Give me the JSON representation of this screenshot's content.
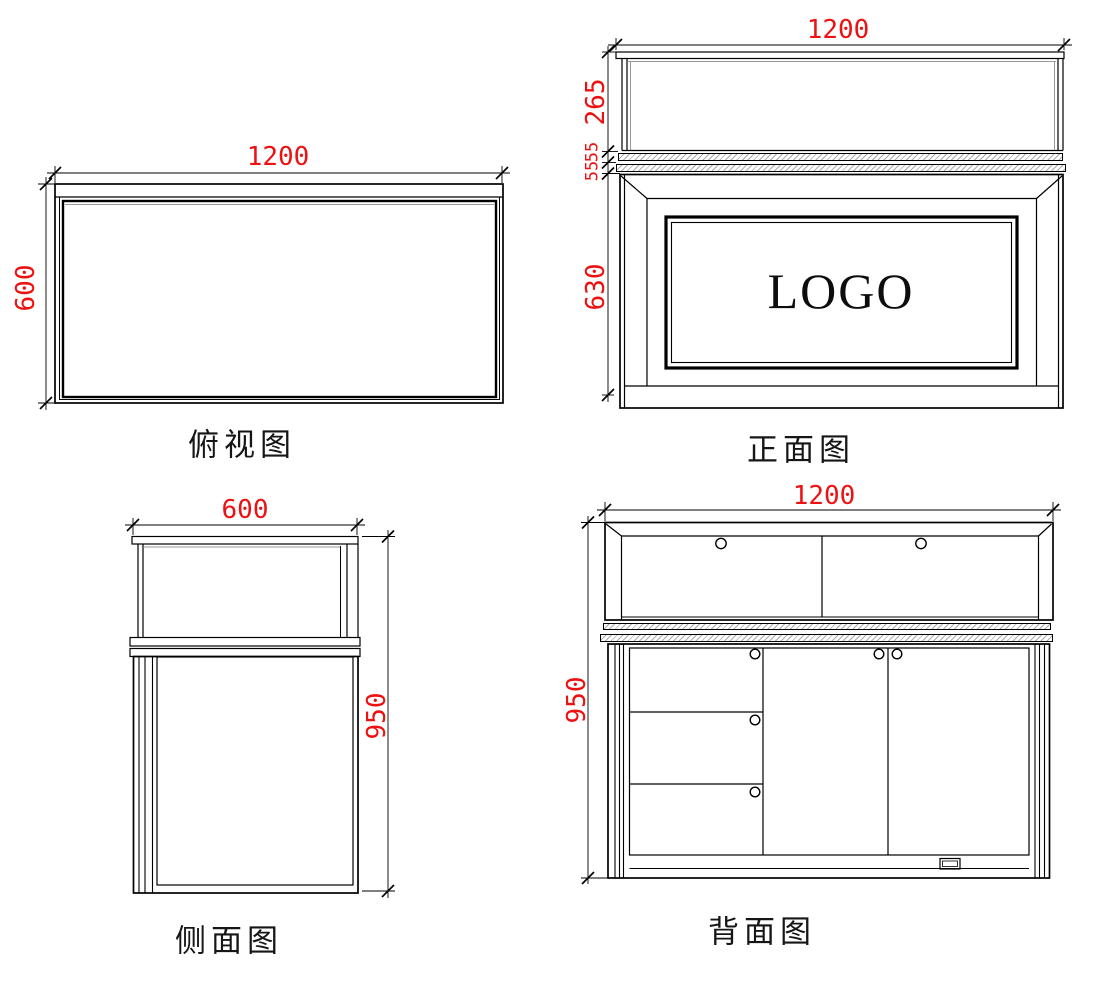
{
  "drawing_title": "display-counter-four-view-drawing",
  "colors": {
    "dimension_text": "#ee1111",
    "line": "#000000",
    "glass_line": "#999999",
    "hatch": "#ababab"
  },
  "views": {
    "top": {
      "label": "俯视图",
      "dim_width": "1200",
      "dim_depth": "600"
    },
    "front": {
      "label": "正面图",
      "dim_width": "1200",
      "dim_glass": "265",
      "dim_band1": "55",
      "dim_band2": "55",
      "dim_body": "630",
      "logo": "LOGO"
    },
    "side": {
      "label": "侧面图",
      "dim_depth": "600",
      "dim_height": "950"
    },
    "back": {
      "label": "背面图",
      "dim_width": "1200",
      "dim_height": "950"
    }
  }
}
